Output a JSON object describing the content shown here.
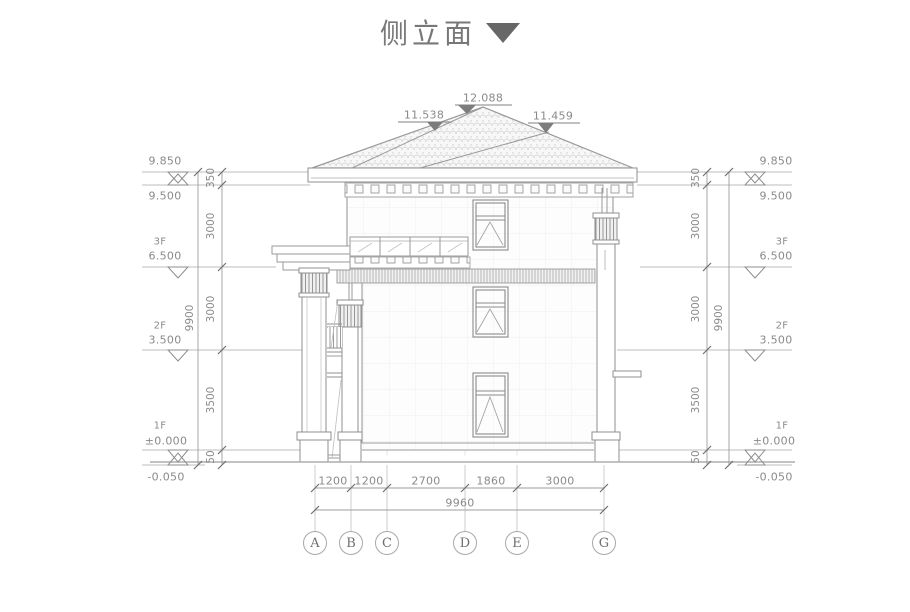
{
  "title": {
    "text": "侧立面"
  },
  "roof_labels": {
    "left": "11.538",
    "peak": "12.088",
    "right": "11.459"
  },
  "levels": {
    "l9850": "9.850",
    "l9500": "9.500",
    "f3": "3F",
    "l6500": "6.500",
    "f2": "2F",
    "l3500": "3.500",
    "f1": "1F",
    "l0": "±0.000",
    "lm050": "-0.050"
  },
  "vdims": {
    "s350": "350",
    "s3000a": "3000",
    "s3000b": "3000",
    "s3500": "3500",
    "s50": "50",
    "total": "9900"
  },
  "hdims": {
    "s1": "1200",
    "s2": "1200",
    "s3": "2700",
    "s4": "1860",
    "s5": "3000",
    "total": "9960"
  },
  "grid_bubbles": [
    "A",
    "B",
    "C",
    "D",
    "E",
    "G"
  ],
  "colors": {
    "line": "#9a9a9a",
    "dim": "#8a8a8a",
    "title": "#787878",
    "arrow": "#676767"
  }
}
